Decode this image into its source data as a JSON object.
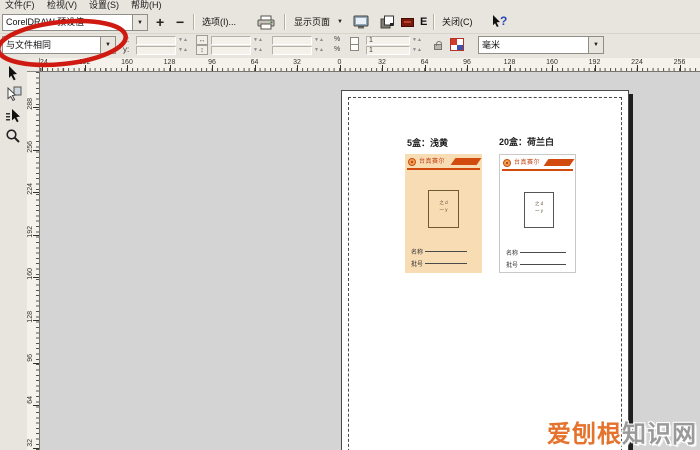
{
  "menu": {
    "items": [
      "文件(F)",
      "检视(V)",
      "设置(S)",
      "帮助(H)"
    ]
  },
  "toolbar": {
    "preset_combo_value": "CorelDRAW 预设值",
    "zoom_in_label": "+",
    "zoom_out_label": "−",
    "options_label": "选项(I)...",
    "show_page_combo_value": "显示页面",
    "enhanced_view_label": "E",
    "close_label": "关闭(C)"
  },
  "property_bar": {
    "position_preset_value": "与文件相同",
    "x_label": "x:",
    "y_label": "y:",
    "percent_label": "%",
    "copies_top": "1",
    "copies_bottom": "1",
    "unit_combo_value": "毫米"
  },
  "rulers": {
    "horizontal_labels": [
      "224",
      "192",
      "160",
      "128",
      "96",
      "64",
      "32",
      "0",
      "32",
      "64",
      "96",
      "128",
      "160",
      "192",
      "224",
      "256"
    ],
    "vertical_labels": [
      "288",
      "256",
      "224",
      "192",
      "160",
      "128",
      "96",
      "64",
      "32"
    ]
  },
  "preview": {
    "caption_left": "5盒：浅黄",
    "caption_right": "20盒：荷兰白",
    "cards": [
      {
        "brand": "台真赛尔",
        "box_line1": "之 d",
        "box_line2": "一 y",
        "field1": "名称",
        "field2": "批号"
      },
      {
        "brand": "台真赛尔",
        "box_line1": "之 d",
        "box_line2": "一 y",
        "field1": "名称",
        "field2": "批号"
      }
    ]
  },
  "watermark": {
    "part1": "爱刨根",
    "part2": "知识网"
  },
  "colors": {
    "accent_orange": "#d24b0e",
    "card_peach": "#f8dcb4",
    "annotation_red": "#cf1a12",
    "watermark_orange": "#e5732d",
    "watermark_gray": "#9a9a9a"
  }
}
